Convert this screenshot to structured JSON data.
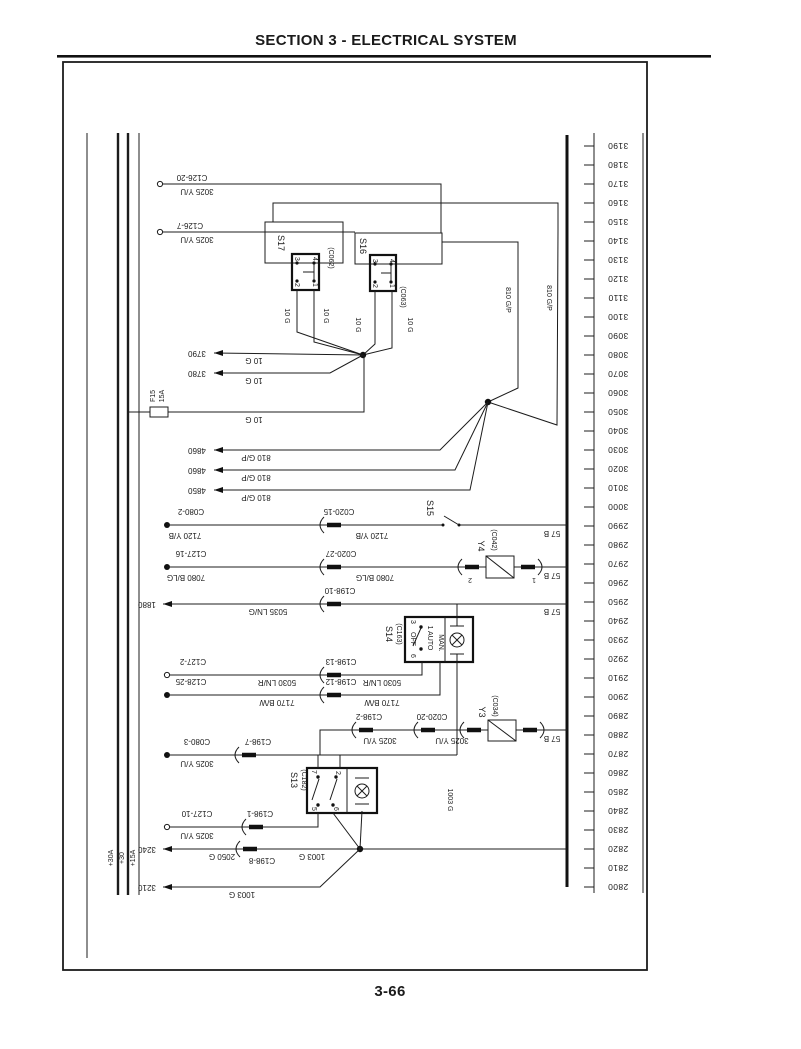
{
  "header": {
    "section_title": "SECTION 3 - ELECTRICAL SYSTEM",
    "page_number": "3-66"
  },
  "grid_ticks": [
    "3190",
    "3180",
    "3170",
    "3160",
    "3150",
    "3140",
    "3130",
    "3120",
    "3110",
    "3100",
    "3090",
    "3080",
    "3070",
    "3060",
    "3050",
    "3040",
    "3030",
    "3020",
    "3010",
    "3000",
    "2990",
    "2980",
    "2970",
    "2960",
    "2950",
    "2940",
    "2930",
    "2920",
    "2910",
    "2900",
    "2890",
    "2880",
    "2870",
    "2860",
    "2850",
    "2840",
    "2830",
    "2820",
    "2810",
    "2800"
  ],
  "bus_labels": {
    "b30a": "+30A",
    "b30": "+30",
    "b15a": "+15A"
  },
  "fuse": {
    "name": "F15",
    "rating": "15A"
  },
  "components": {
    "s17": {
      "id": "S17",
      "connector": "(C062)",
      "t3": "3",
      "t4": "4",
      "t2": "2",
      "t1": "1"
    },
    "s16": {
      "id": "S16",
      "connector": "(C063)",
      "t3": "3",
      "t4": "4",
      "t2": "2",
      "t1": "1"
    },
    "s15": {
      "id": "S15"
    },
    "s14": {
      "id": "S14",
      "connector": "(C163)",
      "t3": "3",
      "pos_off": "OFF",
      "t6": "6",
      "pos_auto": "1 AUTO",
      "pos_man": "MAN."
    },
    "s13": {
      "id": "S13",
      "connector": "(C182)",
      "t7": "7",
      "t2": "2",
      "t5": "5",
      "t6": "6"
    },
    "y4": {
      "id": "Y4",
      "connector": "(C042)",
      "t2": "2",
      "t1": "1"
    },
    "y3": {
      "id": "Y3",
      "connector": "(C034)"
    }
  },
  "connectors": {
    "c126_20": "C126-20",
    "c126_7": "C126-7",
    "c080_2": "C080-2",
    "c020_15": "C020-15",
    "c127_16": "C127-16",
    "c020_27": "C020-27",
    "c198_10": "C198-10",
    "c127_2": "C127-2",
    "c198_13": "C198-13",
    "c128_25": "C128-25",
    "c198_12": "C198-12",
    "c198_2": "C198-2",
    "c020_20": "C020-20",
    "c080_3": "C080-3",
    "c198_7": "C198-7",
    "c127_10": "C127-10",
    "c198_1": "C198-1",
    "c198_8": "C198-8"
  },
  "wire_labels": {
    "w3025": "3025 Y/U",
    "w10g": "10 G",
    "w810": "810 G/P",
    "w7120": "7120 Y/B",
    "w7080": "7080 B/LG",
    "w5035": "5035 LN/G",
    "w5030": "5030 LN/R",
    "w7170": "7170 B/W",
    "w1003": "1003 G",
    "w2050": "2050 G",
    "w57b": "57 B"
  },
  "refs": {
    "r3790": "3790",
    "r3780": "3780",
    "r4860a": "4860",
    "r4860b": "4860",
    "r4850": "4850",
    "r1880": "1880",
    "r3240": "3240",
    "r3210": "3210"
  }
}
